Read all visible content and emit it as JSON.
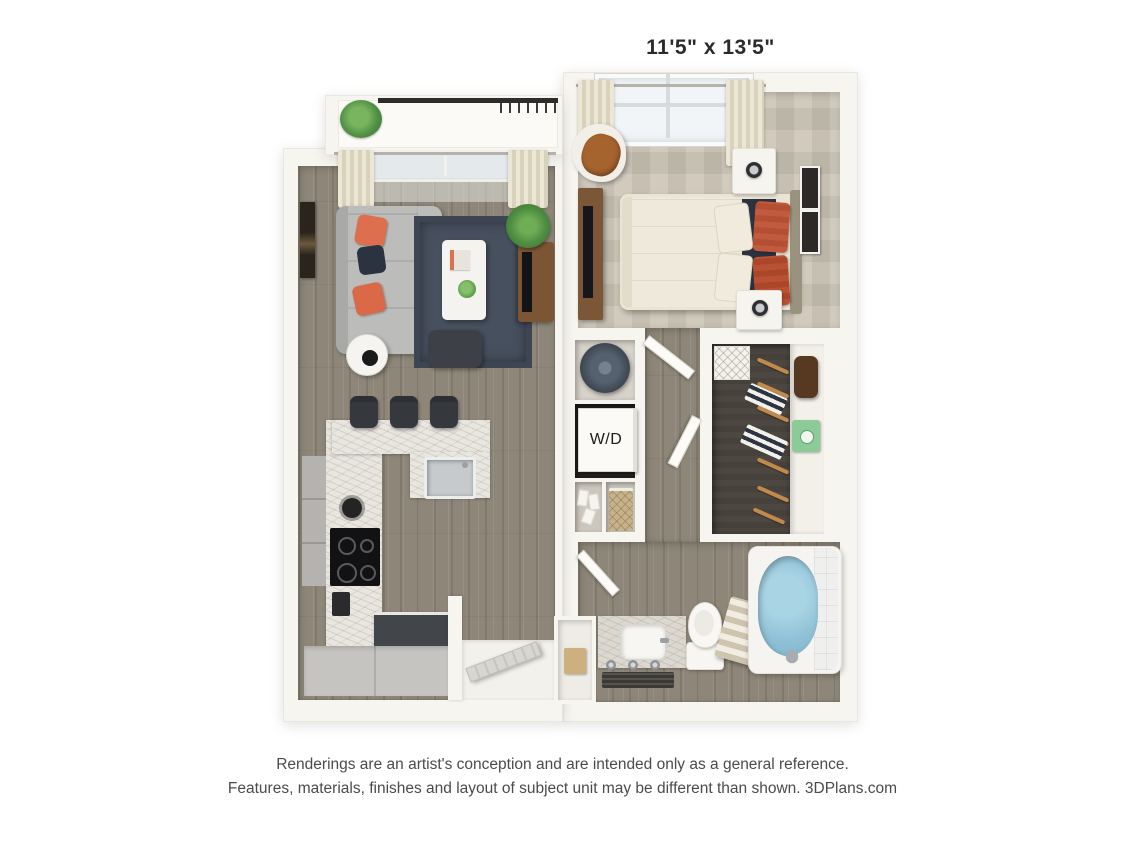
{
  "labels": {
    "bedroom_dims": "11'5\" x 13'5\"",
    "living_dims": "11'4\" x 13'1\"",
    "wd": "W/D"
  },
  "footer": {
    "line1": "Renderings are an artist's conception and are intended only as a general reference.",
    "line2": "Features, materials, finishes and layout of subject unit may be different than shown. 3DPlans.com"
  },
  "colors": {
    "background": "#ffffff",
    "wall": "#f7f5f0",
    "wood_floor": "#8e8779",
    "bedroom_carpet": "#cbc4b5",
    "closet_carpet": "#46413a",
    "marble_counter": "#e9e6e0",
    "rug_navy": "#47505e",
    "accent_coral": "#dd6f4e",
    "accent_navy": "#2b3240",
    "tub_water": "#92c3d8",
    "dimension_text": "#2b2b2b",
    "disclaimer_text": "#4b4b4b"
  }
}
